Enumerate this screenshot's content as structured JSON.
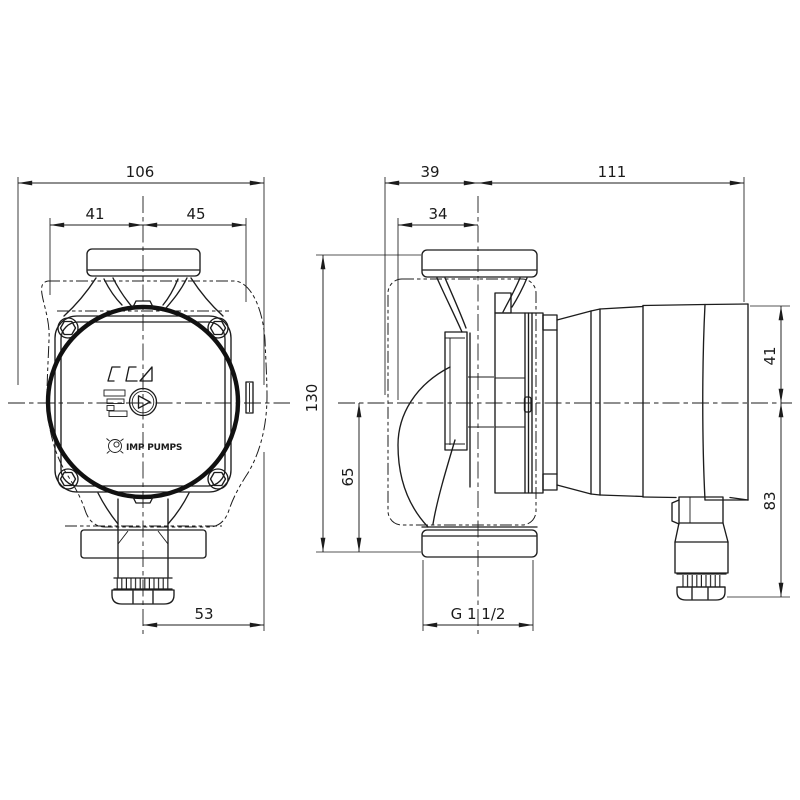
{
  "drawing": {
    "brand": {
      "logo_text": "IMP PUMPS"
    },
    "front_view": {
      "overall_width": "106",
      "left_offset": "41",
      "right_offset": "45",
      "half_width": "53"
    },
    "side_view": {
      "rear_offset": "39",
      "motor_length": "111",
      "volute_offset": "34",
      "port_to_port": "130",
      "lower_height": "65",
      "motor_upper_half": "41",
      "motor_lower_half": "83",
      "connection_thread": "G 1 1/2"
    }
  }
}
